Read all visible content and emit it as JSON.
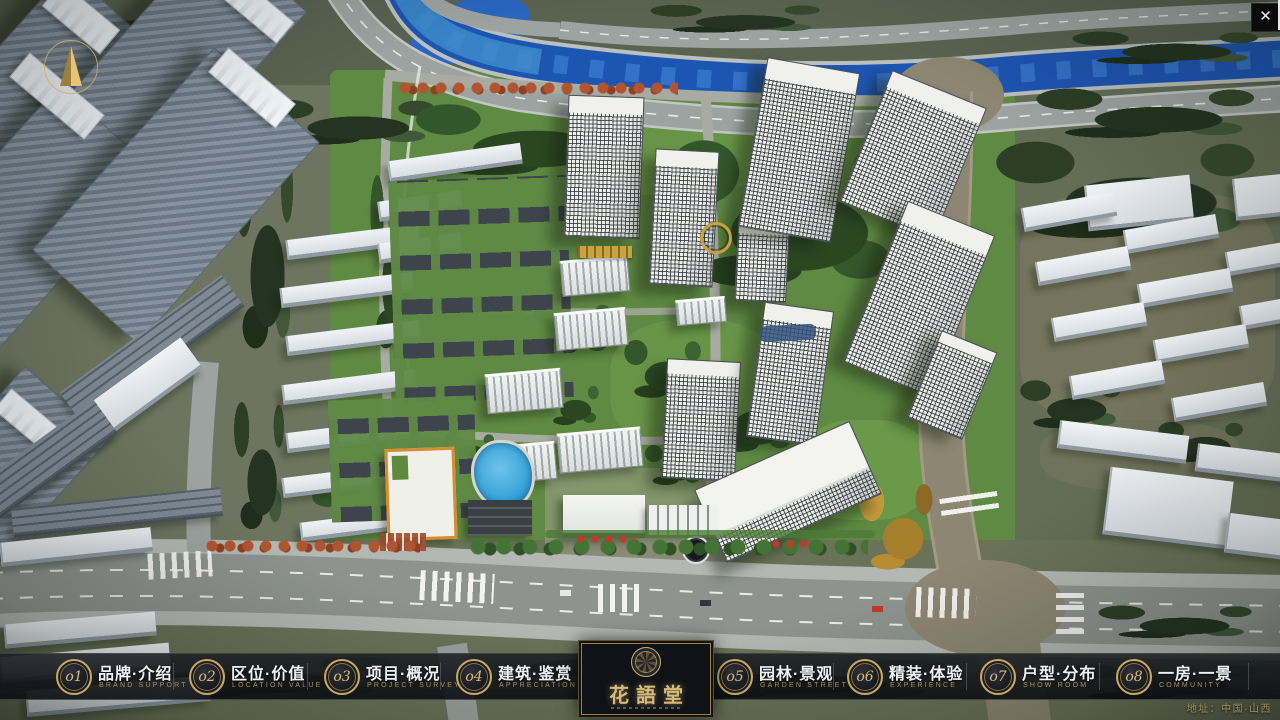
{
  "nav": {
    "items": [
      {
        "num": "o1",
        "label": "品牌·介绍",
        "sub": "BRAND SUPPORT"
      },
      {
        "num": "o2",
        "label": "区位·价值",
        "sub": "LOCATION VALUE"
      },
      {
        "num": "o3",
        "label": "项目·概况",
        "sub": "PROJECT SURVEY"
      },
      {
        "num": "o4",
        "label": "建筑·鉴赏",
        "sub": "APPRECIATION"
      },
      {
        "num": "o5",
        "label": "园林·景观",
        "sub": "GARDEN STREET"
      },
      {
        "num": "o6",
        "label": "精装·体验",
        "sub": "EXPERIENCE"
      },
      {
        "num": "o7",
        "label": "户型·分布",
        "sub": "SHOW ROOM"
      },
      {
        "num": "o8",
        "label": "一房·一景",
        "sub": "COMMUNITY"
      }
    ],
    "brand": {
      "name": "花語堂"
    },
    "address": "地址：中国·山西",
    "colors": {
      "gold": "#c9a866",
      "text": "#eef0f2",
      "sub_gold": "#ad8f58"
    }
  },
  "titlebar": {
    "close_label": "✕"
  }
}
